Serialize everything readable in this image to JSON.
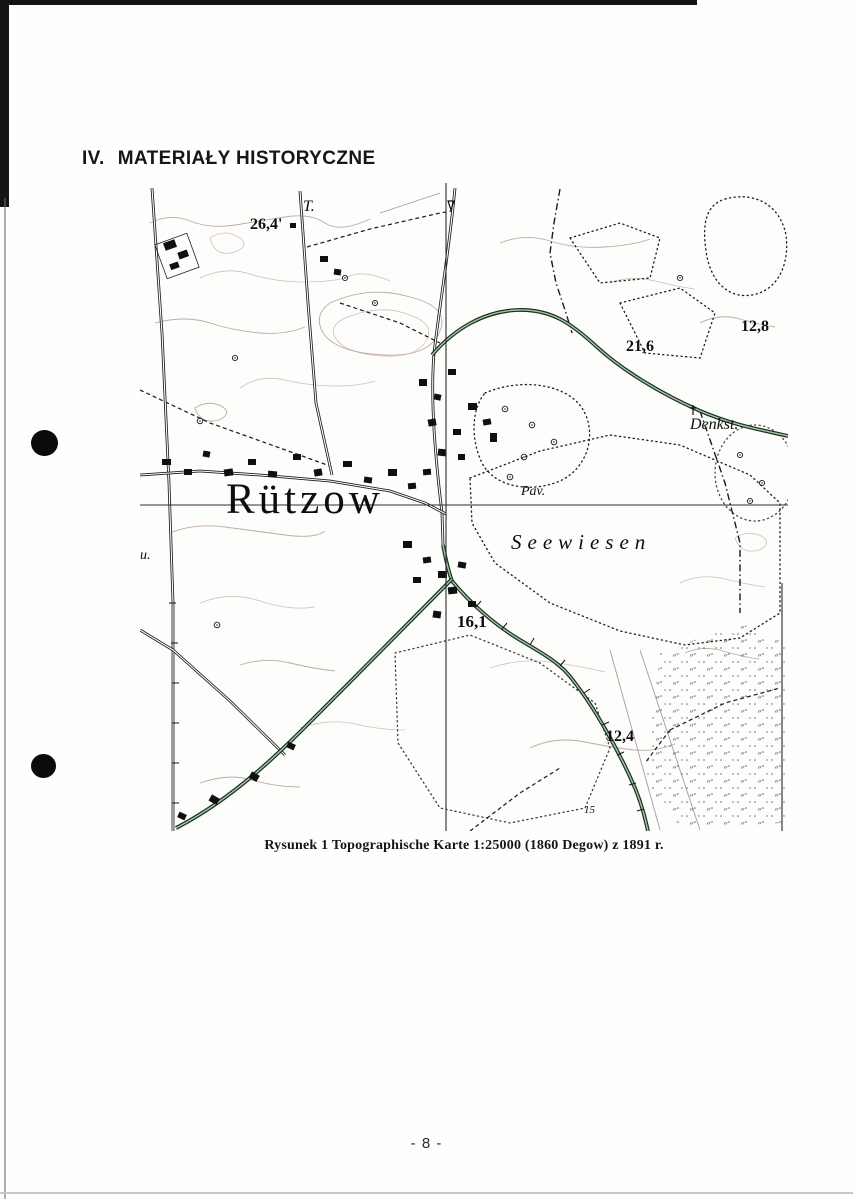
{
  "page": {
    "heading": {
      "number": "IV.",
      "title": "MATERIAŁY HISTORYCZNE"
    },
    "page_number": "- 8 -"
  },
  "figure": {
    "caption": "Rysunek 1 Topographische Karte 1:25000 (1860 Degow) z 1891 r."
  },
  "map": {
    "labels": {
      "settlement": "Rützow",
      "meadow": "Seewiesen",
      "monument": "Denkst.",
      "pavilion": "Pav.",
      "point_t": "T.",
      "edge_fragment": "u.",
      "elev_26_4": "26,4'",
      "elev_21_6": "21,6",
      "elev_12_8": "12,8",
      "elev_16_1": "16,1",
      "elev_12_4": "12,4",
      "elev_15": "15"
    }
  },
  "colors": {
    "paper": "#fefefe",
    "scan_edge_black": "#141414",
    "map_ink": "#111111",
    "contour_sepia": "#b29494",
    "chaussee_green": "#17301f",
    "pond_fill": "#7c7c7c"
  }
}
